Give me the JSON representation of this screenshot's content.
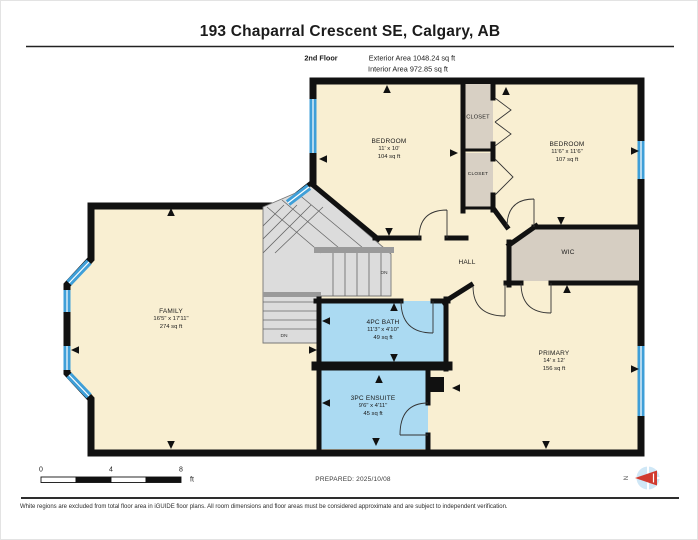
{
  "header": {
    "title": "193 Chaparral Crescent SE, Calgary, AB",
    "floor_label": "2nd Floor",
    "exterior_area": "Exterior Area 1048.24 sq ft",
    "interior_area": "Interior Area 972.85 sq ft"
  },
  "rooms": {
    "bedroom_left": {
      "name": "BEDROOM",
      "dims": "11' x 10'",
      "area": "104 sq ft"
    },
    "bedroom_right": {
      "name": "BEDROOM",
      "dims": "11'6\" x 11'6\"",
      "area": "107 sq ft"
    },
    "closet_top": {
      "name": "CLOSET"
    },
    "closet_bottom": {
      "name": "CLOSET"
    },
    "hall": {
      "name": "HALL"
    },
    "wic": {
      "name": "WIC"
    },
    "family": {
      "name": "FAMILY",
      "dims": "16'5\" x 17'11\"",
      "area": "274 sq ft"
    },
    "bath": {
      "name": "4PC BATH",
      "dims": "11'3\" x 4'10\"",
      "area": "49 sq ft"
    },
    "ensuite": {
      "name": "3PC ENSUITE",
      "dims": "9'6\" x 4'11\"",
      "area": "45 sq ft"
    },
    "primary": {
      "name": "PRIMARY",
      "dims": "14' x 12'",
      "area": "156 sq ft"
    }
  },
  "stairs": {
    "dn_upper": "DN",
    "dn_lower": "DN"
  },
  "scale_bar": {
    "t0": "0",
    "t4": "4",
    "t8": "8",
    "unit": "ft"
  },
  "prepared": "PREPARED: 2025/10/08",
  "compass": {
    "north": "N"
  },
  "footer": "White regions are excluded from total floor area in iGUIDE floor plans. All room dimensions and floor areas must be considered approximate and are subject to independent verification.",
  "colors": {
    "room_fill": "#f9efd2",
    "closet_fill": "#d8d0c4",
    "stairs_fill": "#dcdcdc",
    "bath_fill": "#abdaf2",
    "window_blue": "#3f9fd8",
    "wall": "#111111",
    "compass_red": "#d13b30"
  }
}
